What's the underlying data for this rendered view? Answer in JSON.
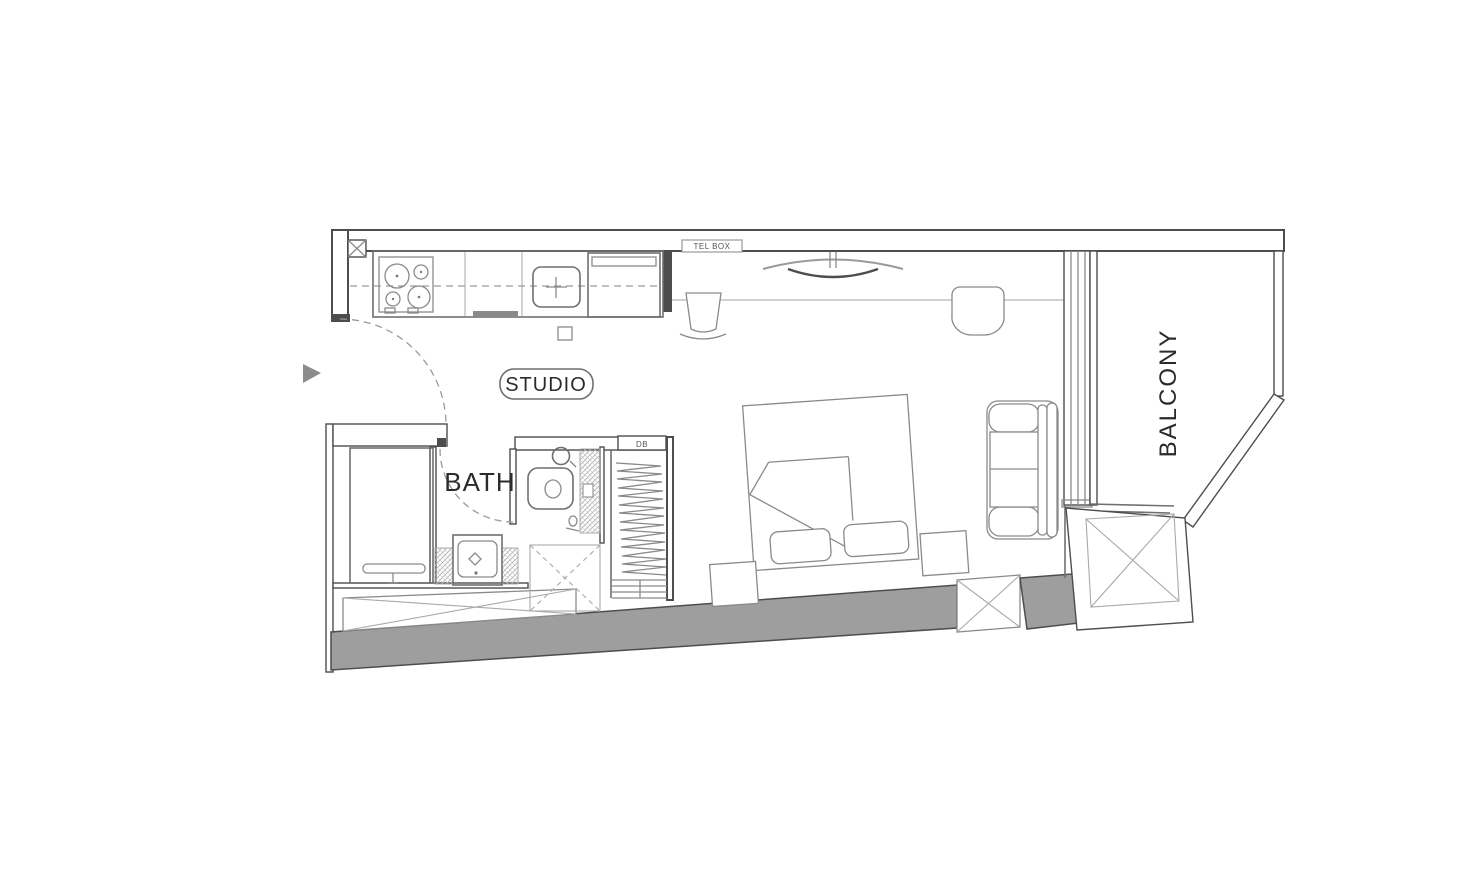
{
  "title": "Studio apartment floor plan",
  "labels": {
    "studio": "STUDIO",
    "bath": "BATH",
    "balcony": "BALCONY",
    "tel_box": "TEL BOX",
    "db": "DB"
  },
  "colors": {
    "background": "#ffffff",
    "wall_outline": "#4d4d4d",
    "thin_line": "#8a8a8a",
    "light_line": "#b5b5b5",
    "gray_fill": "#9e9e9e",
    "arrow_fill": "#8c8c8c",
    "text": "#2b2b2b"
  }
}
